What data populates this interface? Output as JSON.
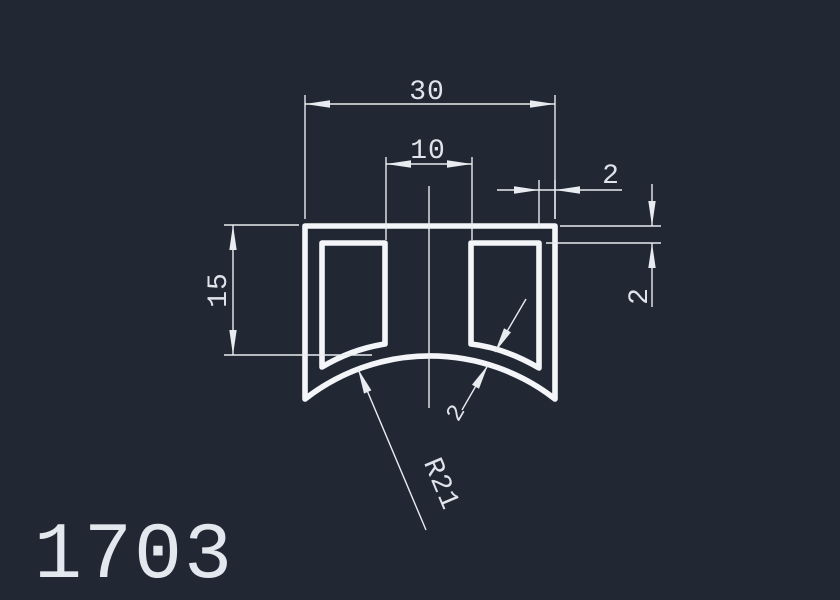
{
  "drawing": {
    "part_label": "1703",
    "colors": {
      "background": "#212833",
      "profile_line": "#f3f5f8",
      "dimension_line": "#e8ecf0",
      "text": "#dfe4ea"
    },
    "dims": {
      "overall_width": "30",
      "center_web_width": "10",
      "right_wall_thickness": "2",
      "top_wall_thickness": "2",
      "side_height": "15",
      "bottom_radius": "R21",
      "bottom_wall_thickness": "2"
    }
  }
}
